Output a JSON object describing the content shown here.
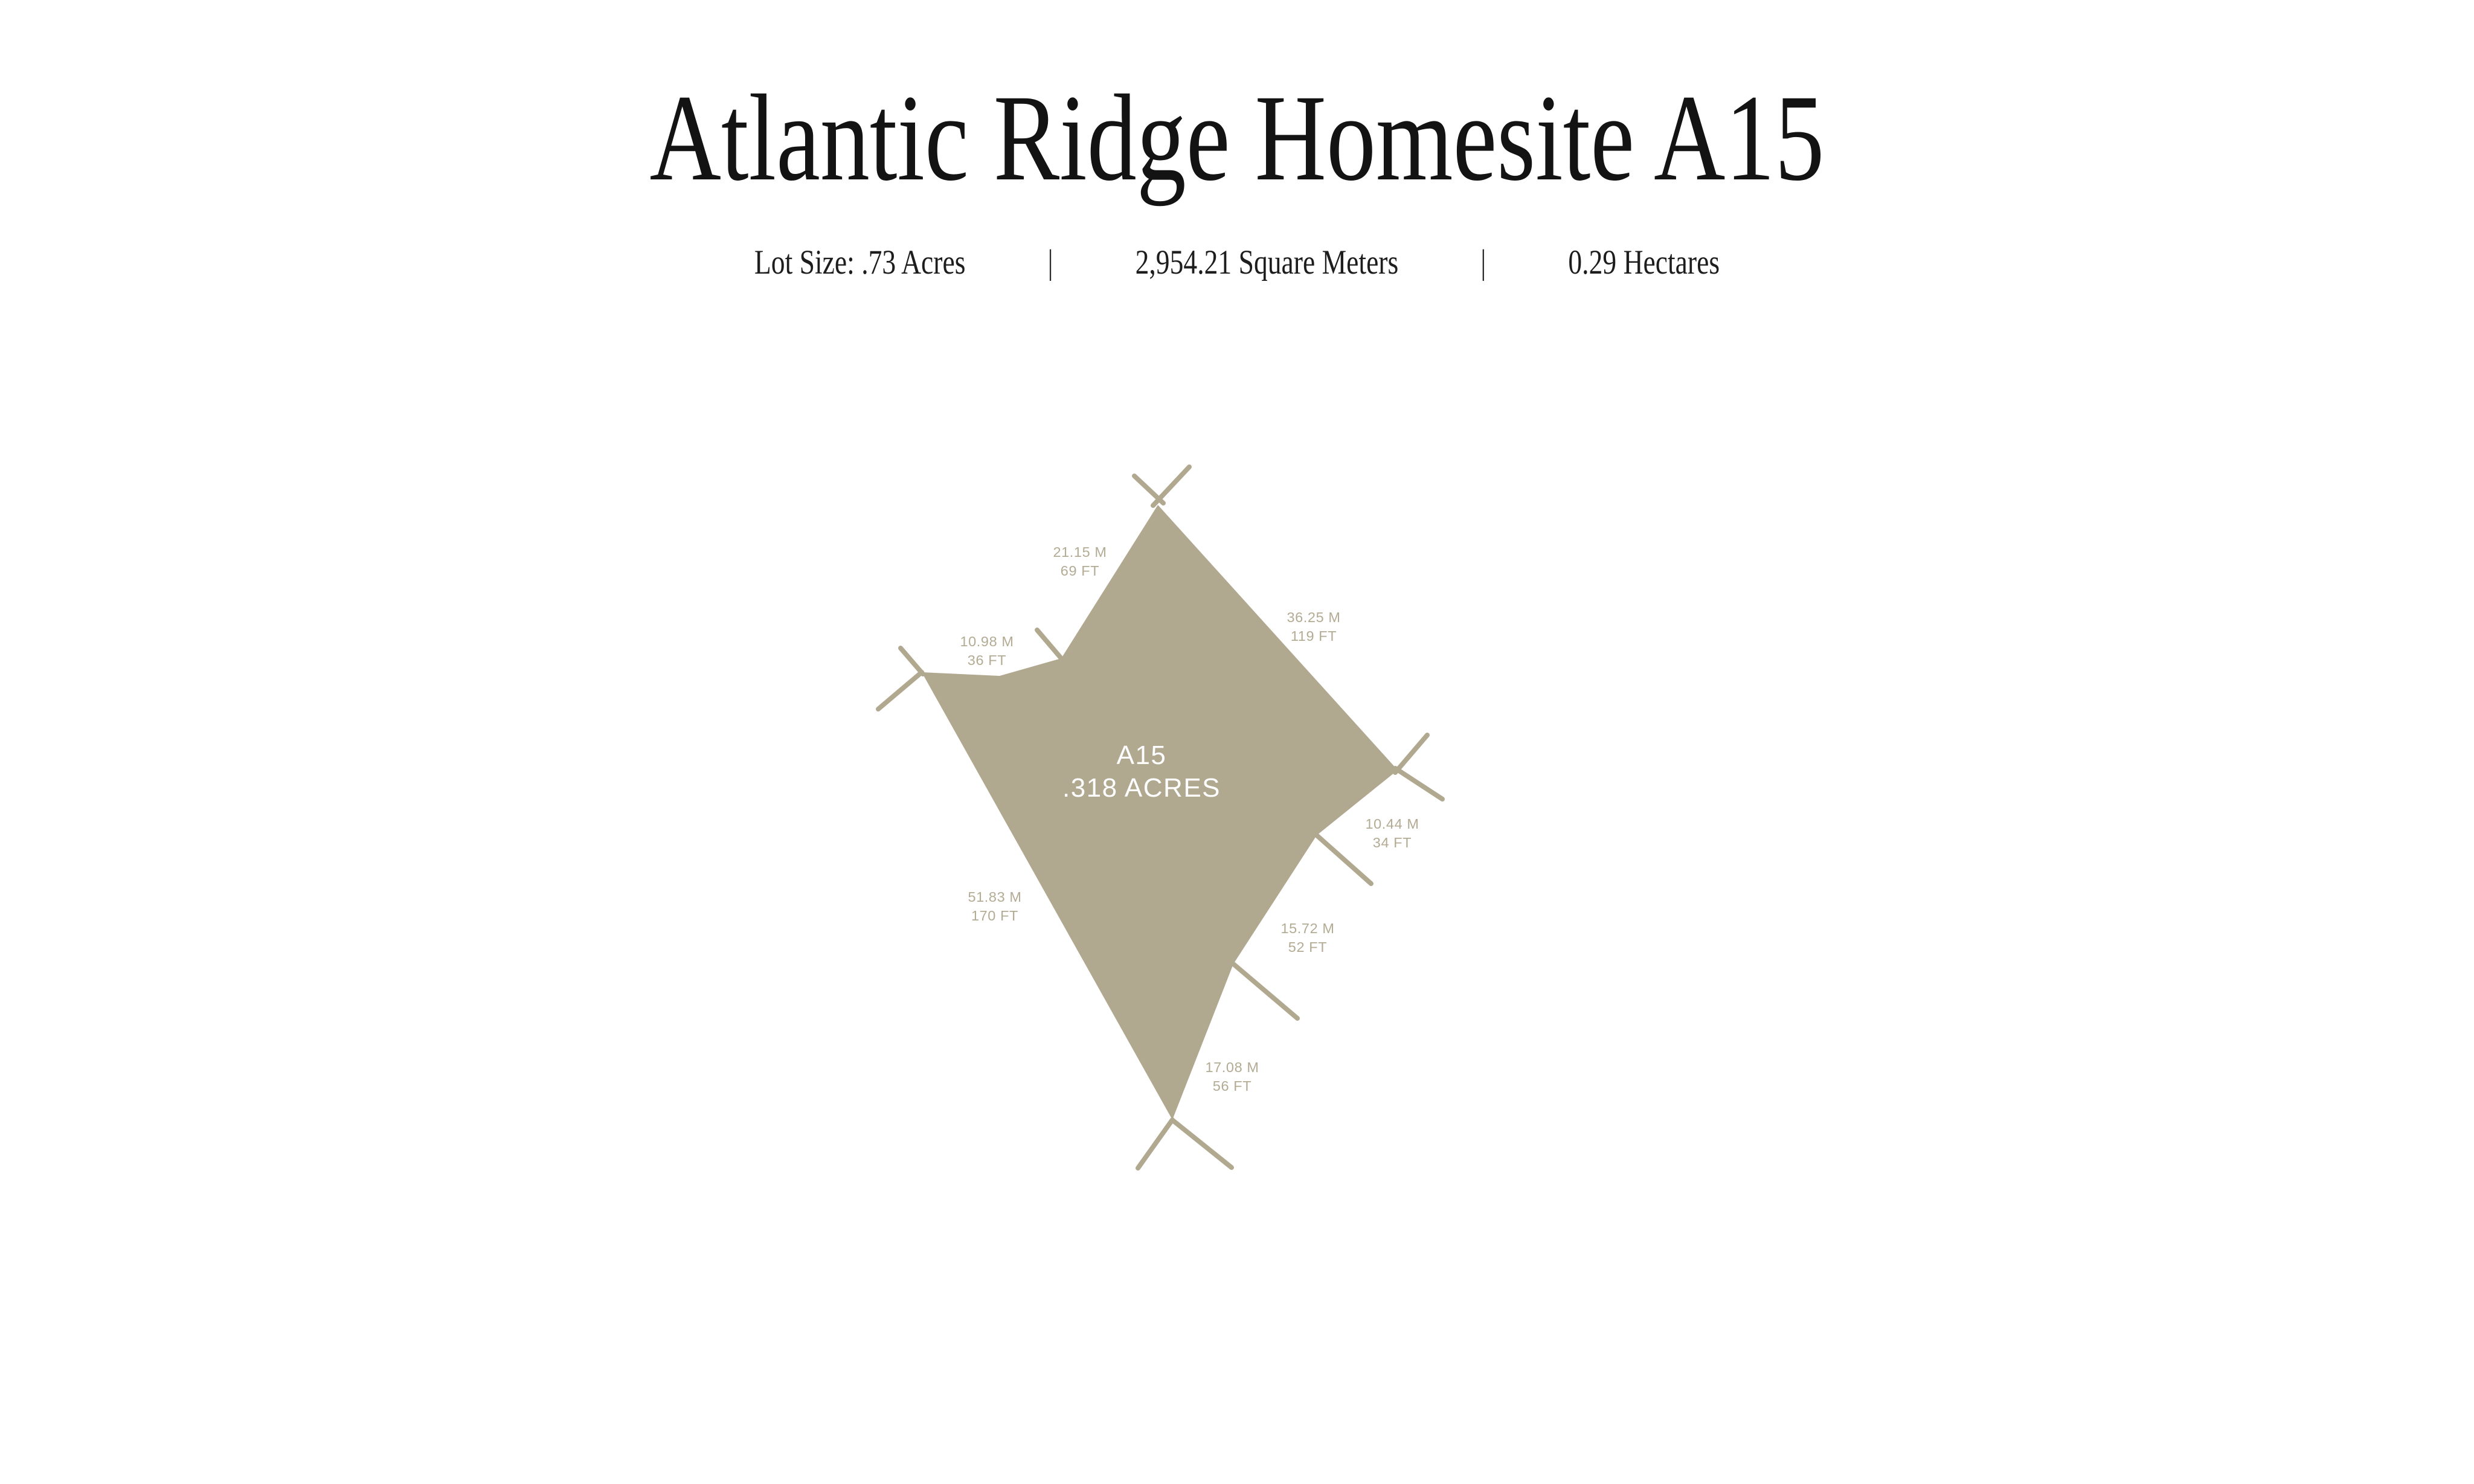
{
  "header": {
    "title": "Atlantic Ridge Homesite A15",
    "divider": "|",
    "stats": [
      "Lot Size: .73 Acres",
      "2,954.21 Square Meters",
      "0.29 Hectares"
    ]
  },
  "lot": {
    "id_label": "A15",
    "area_label": ".318 ACRES",
    "fill_color": "#b1a890",
    "label_color": "#b3ab93",
    "center_text_color": "#ffffff",
    "ink_color": "#131313",
    "edges": [
      {
        "side": "upper-left",
        "meters": "21.15 M",
        "feet": "69 FT"
      },
      {
        "side": "upper-right",
        "meters": "36.25 M",
        "feet": "119 FT"
      },
      {
        "side": "right",
        "meters": "10.44 M",
        "feet": "34 FT"
      },
      {
        "side": "lower-right",
        "meters": "15.72 M",
        "feet": "52 FT"
      },
      {
        "side": "bottom-right",
        "meters": "17.08 M",
        "feet": "56 FT"
      },
      {
        "side": "lower-left",
        "meters": "51.83 M",
        "feet": "170 FT"
      },
      {
        "side": "left",
        "meters": "10.98 M",
        "feet": "36 FT"
      }
    ]
  }
}
